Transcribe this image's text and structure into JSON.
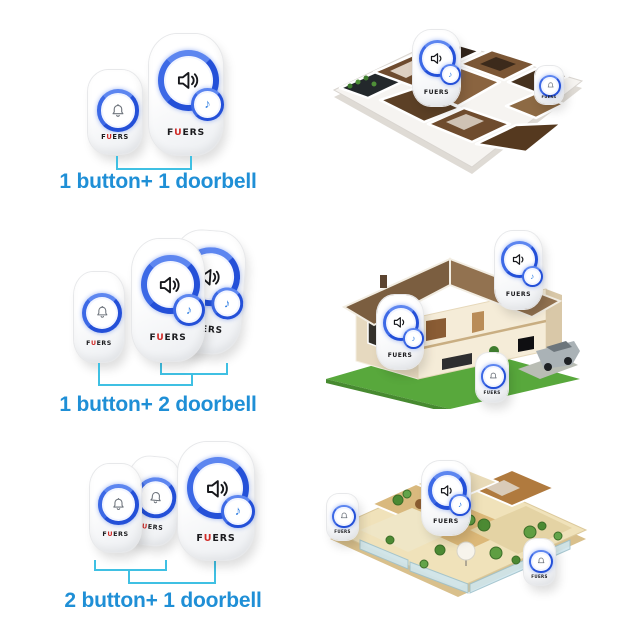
{
  "brand": "FUERS",
  "brand_parts": [
    "F",
    "U",
    "ERS"
  ],
  "icons": {
    "bell": "bell-icon",
    "speaker": "speaker-icon",
    "music_note": "♪"
  },
  "colors": {
    "background": "#ffffff",
    "label_blue": "#1f8fd6",
    "bracket_cyan": "#3fc0e3",
    "ring_blue": "#2450d8",
    "brand_red": "#d02b27"
  },
  "kits": [
    {
      "label": "1 button+ 1 doorbell",
      "buttons": 1,
      "doorbells": 1,
      "scene": "apartment-floorplan"
    },
    {
      "label": "1 button+ 2 doorbell",
      "buttons": 1,
      "doorbells": 2,
      "scene": "house-cutaway"
    },
    {
      "label": "2 button+ 1 doorbell",
      "buttons": 2,
      "doorbells": 1,
      "scene": "penthouse-floorplan"
    }
  ]
}
